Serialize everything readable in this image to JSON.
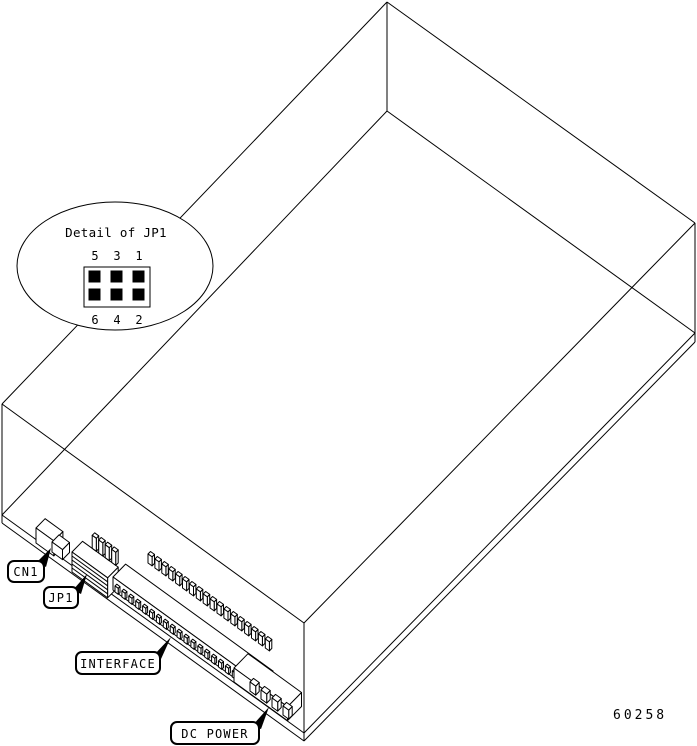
{
  "figure_number": "60258",
  "detail_callout": {
    "title": "Detail of JP1",
    "pins_top": [
      "5",
      "3",
      "1"
    ],
    "pins_bottom": [
      "6",
      "4",
      "2"
    ]
  },
  "connector_labels": {
    "cn1": "CN1",
    "jp1": "JP1",
    "interface": "INTERFACE",
    "dc_power": "DC POWER"
  },
  "colors": {
    "line": "#000000",
    "background": "#ffffff"
  }
}
